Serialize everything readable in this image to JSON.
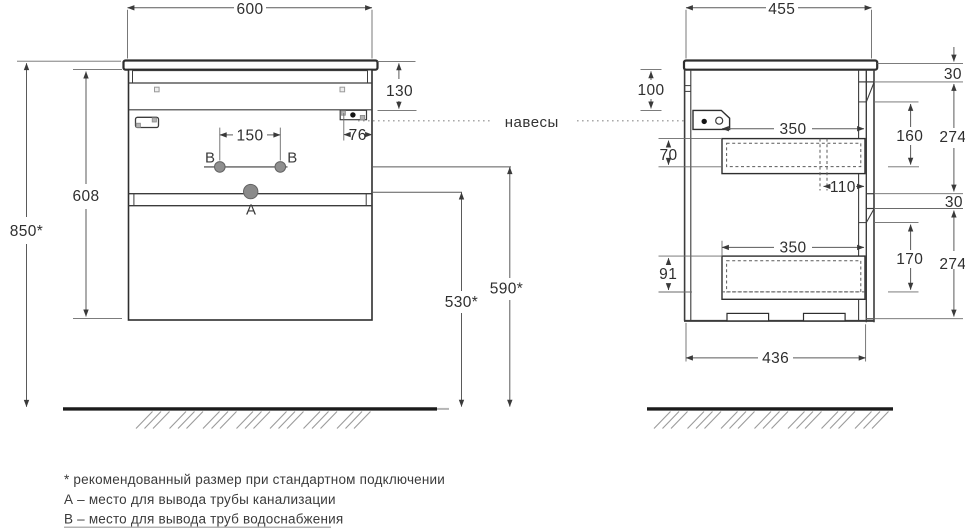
{
  "front_view": {
    "dims": {
      "width": "600",
      "height_from_floor": "850*",
      "body_height": "608",
      "top_clearance": "130",
      "hanger_offset": "76",
      "supply_spacing": "150",
      "drain_height": "530*",
      "supply_height": "590*"
    },
    "labels": {
      "drain": "A",
      "supply_left": "B",
      "supply_right": "B"
    }
  },
  "side_view": {
    "dims": {
      "depth": "455",
      "hanger_drop": "100",
      "top_gap": "30",
      "front1_recess": "160",
      "front1_height": "274",
      "drawer1_depth": "350",
      "drawer1_inner_height": "70",
      "siphon_offset": "110",
      "middle_gap": "30",
      "front2_recess": "170",
      "front2_height": "274",
      "drawer2_depth": "350",
      "drawer2_inner_height": "91",
      "bottom_depth": "436"
    }
  },
  "annotations": {
    "hangers": "навесы"
  },
  "footnotes": {
    "recommended": "* рекомендованный размер при стандартном подключении",
    "drain_note": "А – место для вывода трубы канализации",
    "supply_note": "В – место для вывода труб водоснабжения"
  },
  "colors": {
    "line": "#2e2e2e",
    "dim": "#555555",
    "hole": "#8f8f8f",
    "ground": "#1b1b1b",
    "hatch": "#9b9b9b"
  }
}
